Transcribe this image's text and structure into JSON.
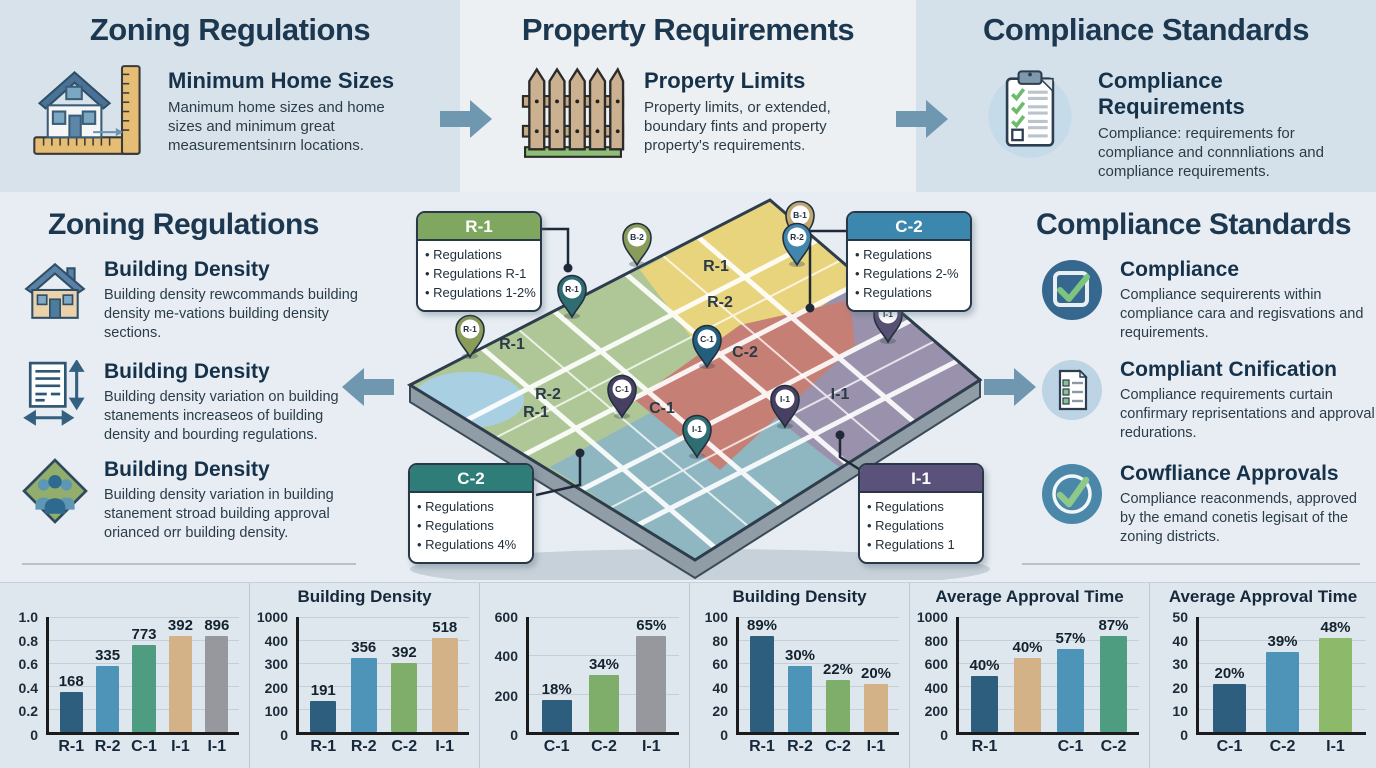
{
  "colors": {
    "accent_arrow": "#7097b0",
    "title": "#1c3850"
  },
  "top_band": {
    "sections": [
      {
        "title": "Zoning Regulations",
        "icon": "house-ruler-icon",
        "heading": "Minimum Home Sizes",
        "body": "Manimum home sizes and home sizes and minimum great measurementsinırn locations."
      },
      {
        "title": "Property Requirements",
        "icon": "fence-icon",
        "heading": "Property Limits",
        "body": "Property limits, or extended, boundary fints and property property's requirements."
      },
      {
        "title": "Compliance Standards",
        "icon": "clipboard-checklist-icon",
        "heading": "Compliance Requirements",
        "body": "Compliance: requirements for compliance and connnliations and compliance requirements."
      }
    ]
  },
  "left_panel": {
    "title": "Zoning Regulations",
    "items": [
      {
        "icon": "house-icon",
        "heading": "Building Density",
        "body": "Building density rewcommands building density me-vations building density sections."
      },
      {
        "icon": "document-measure-icon",
        "heading": "Building Density",
        "body": "Building density variation on building stanements increaseos of building density and bourding regulations."
      },
      {
        "icon": "people-diamond-icon",
        "heading": "Building Density",
        "body": "Building density variation in building stanement stroad building approval orianced orr building density."
      }
    ]
  },
  "right_panel": {
    "title": "Compliance Standards",
    "items": [
      {
        "icon": "checkbox-icon",
        "heading": "Compliance",
        "body": "Compliance sequirerents within compliance cara and regisvations and requirements."
      },
      {
        "icon": "document-check-icon",
        "heading": "Compliant Cnification",
        "body": "Compliance requirements curtain confirmary reprisentations and approval redurations."
      },
      {
        "icon": "circle-check-icon",
        "heading": "Cowfliance Approvals",
        "body": "Compliance reaconmends, approved by the emand conetis legisaıt of the zoning districts."
      }
    ]
  },
  "map": {
    "callouts": [
      {
        "id": "R-1",
        "header_color": "#7fa75f",
        "bullets": [
          "Regulations",
          "Regulations R-1",
          "Regulations 1-2%"
        ]
      },
      {
        "id": "C-2",
        "header_color": "#3c87ad",
        "bullets": [
          "Regulations",
          "Regulations 2-%",
          "Regulations"
        ]
      },
      {
        "id": "C-2",
        "header_color": "#2e7d78",
        "bullets": [
          "Regulations",
          "Regulations",
          "Regulations 4%"
        ]
      },
      {
        "id": "I-1",
        "header_color": "#5a527a",
        "bullets": [
          "Regulations",
          "Regulations",
          "Regulations 1"
        ]
      }
    ],
    "zone_labels": [
      {
        "text": "R-1",
        "x": 316,
        "y": 72
      },
      {
        "text": "R-2",
        "x": 320,
        "y": 108
      },
      {
        "text": "C-2",
        "x": 345,
        "y": 158
      },
      {
        "text": "I-1",
        "x": 440,
        "y": 200
      },
      {
        "text": "R-1",
        "x": 112,
        "y": 150
      },
      {
        "text": "R-2",
        "x": 148,
        "y": 200
      },
      {
        "text": "R-1",
        "x": 136,
        "y": 218
      },
      {
        "text": "C-1",
        "x": 262,
        "y": 214
      }
    ],
    "pins": [
      {
        "label": "B-1",
        "color": "#c0a86e",
        "x": 400,
        "y": 48
      },
      {
        "label": "B-2",
        "color": "#8a9c5a",
        "x": 237,
        "y": 70
      },
      {
        "label": "R-2",
        "color": "#4186ad",
        "x": 397,
        "y": 70
      },
      {
        "label": "R-1",
        "color": "#2e6e73",
        "x": 172,
        "y": 122
      },
      {
        "label": "R-1",
        "color": "#8a9c5a",
        "x": 70,
        "y": 162
      },
      {
        "label": "C-1",
        "color": "#235e7d",
        "x": 307,
        "y": 172
      },
      {
        "label": "I-1",
        "color": "#575073",
        "x": 488,
        "y": 147
      },
      {
        "label": "C-1",
        "color": "#474063",
        "x": 222,
        "y": 222
      },
      {
        "label": "I-1",
        "color": "#474063",
        "x": 385,
        "y": 232
      },
      {
        "label": "I-1",
        "color": "#2e6e73",
        "x": 297,
        "y": 262
      }
    ]
  },
  "chart_data": [
    {
      "type": "bar",
      "title": "",
      "yticks": [
        "1.0",
        "0.8",
        "0.6",
        "0.4",
        "0.2",
        "0"
      ],
      "bars": [
        {
          "label": "R-1",
          "value": "168",
          "h": 0.35,
          "color": "#2d5e7e"
        },
        {
          "label": "R-2",
          "value": "335",
          "h": 0.57,
          "color": "#4e94b8"
        },
        {
          "label": "C-1",
          "value": "773",
          "h": 0.76,
          "color": "#4e9d80"
        },
        {
          "label": "I-1",
          "value": "392",
          "h": 0.9,
          "color": "#d3b288"
        },
        {
          "label": "I-1",
          "value": "896",
          "h": 0.97,
          "color": "#97979e"
        }
      ]
    },
    {
      "type": "bar",
      "title": "Building Density",
      "yticks": [
        "1000",
        "400",
        "300",
        "200",
        "100",
        "0"
      ],
      "bars": [
        {
          "label": "R-1",
          "value": "191",
          "h": 0.27,
          "color": "#2d5e7e"
        },
        {
          "label": "R-2",
          "value": "356",
          "h": 0.64,
          "color": "#4e94b8"
        },
        {
          "label": "C-2",
          "value": "392",
          "h": 0.6,
          "color": "#7fae6b"
        },
        {
          "label": "I-1",
          "value": "518",
          "h": 0.82,
          "color": "#d3b288"
        }
      ]
    },
    {
      "type": "bar",
      "title": "",
      "yticks": [
        "600",
        "400",
        "200",
        "0"
      ],
      "bars": [
        {
          "label": "C-1",
          "value": "18%",
          "h": 0.28,
          "color": "#2d5e7e"
        },
        {
          "label": "C-2",
          "value": "34%",
          "h": 0.5,
          "color": "#7fae6b"
        },
        {
          "label": "I-1",
          "value": "65%",
          "h": 0.87,
          "color": "#97979e"
        }
      ]
    },
    {
      "type": "bar",
      "title": "Building Density",
      "yticks": [
        "100",
        "80",
        "60",
        "40",
        "20",
        "0"
      ],
      "bars": [
        {
          "label": "R-1",
          "value": "89%",
          "h": 0.85,
          "color": "#2d5e7e"
        },
        {
          "label": "R-2",
          "value": "30%",
          "h": 0.57,
          "color": "#4e94b8"
        },
        {
          "label": "C-2",
          "value": "22%",
          "h": 0.45,
          "color": "#7fae6b"
        },
        {
          "label": "I-1",
          "value": "20%",
          "h": 0.42,
          "color": "#d3b288"
        }
      ]
    },
    {
      "type": "bar",
      "title": "Average Approval Time",
      "yticks": [
        "1000",
        "800",
        "600",
        "400",
        "200",
        "0"
      ],
      "bars": [
        {
          "label": "R-1",
          "value": "40%",
          "h": 0.49,
          "color": "#2d5e7e"
        },
        {
          "label": "",
          "value": "40%",
          "h": 0.64,
          "color": "#d3b288"
        },
        {
          "label": "C-1",
          "value": "57%",
          "h": 0.72,
          "color": "#4e94b8"
        },
        {
          "label": "C-2",
          "value": "87%",
          "h": 0.86,
          "color": "#4e9d80"
        }
      ]
    },
    {
      "type": "bar",
      "title": "Average Approval Time",
      "yticks": [
        "50",
        "40",
        "30",
        "20",
        "10",
        "0"
      ],
      "bars": [
        {
          "label": "C-1",
          "value": "20%",
          "h": 0.42,
          "color": "#2d5e7e"
        },
        {
          "label": "C-2",
          "value": "39%",
          "h": 0.7,
          "color": "#4e94b8"
        },
        {
          "label": "I-1",
          "value": "48%",
          "h": 0.82,
          "color": "#8cba6a"
        }
      ]
    }
  ]
}
